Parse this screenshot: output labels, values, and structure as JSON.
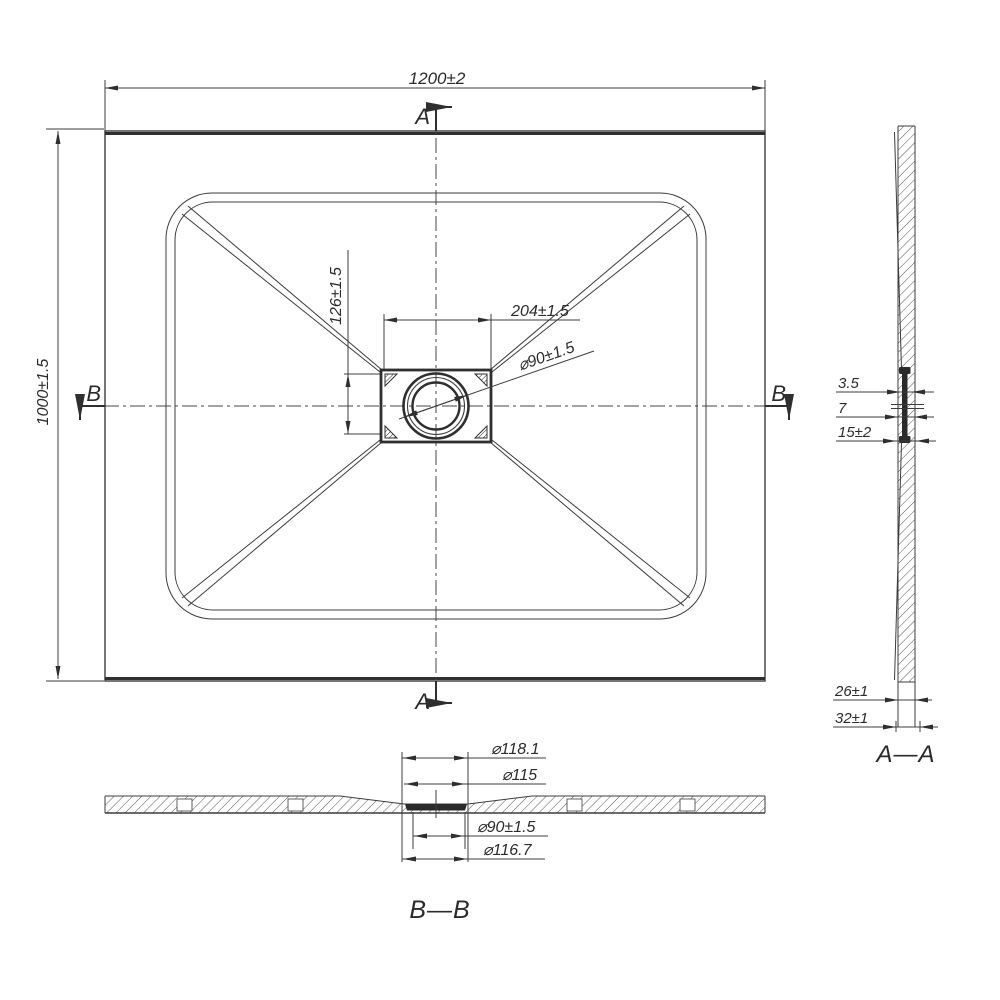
{
  "drawing": {
    "background": "#ffffff",
    "line_color": "#3c3c3c",
    "plan": {
      "width_dim": "1200±2",
      "height_dim": "1000±1.5",
      "drain_width_dim": "204±1.5",
      "drain_height_dim": "126±1.5",
      "drain_diameter_dim": "⌀90±1.5",
      "section_marker_a": "A",
      "section_marker_b": "B"
    },
    "section_aa": {
      "title": "A—A",
      "dim_lip": "3.5",
      "dim_wall": "7",
      "dim_flange": "15±2",
      "dim_base_inner": "26±1",
      "dim_base_outer": "32±1"
    },
    "section_bb": {
      "title": "B—B",
      "dim_d1": "⌀118.1",
      "dim_d2": "⌀115",
      "dim_d3": "⌀90±1.5",
      "dim_d4": "⌀116.7"
    }
  }
}
